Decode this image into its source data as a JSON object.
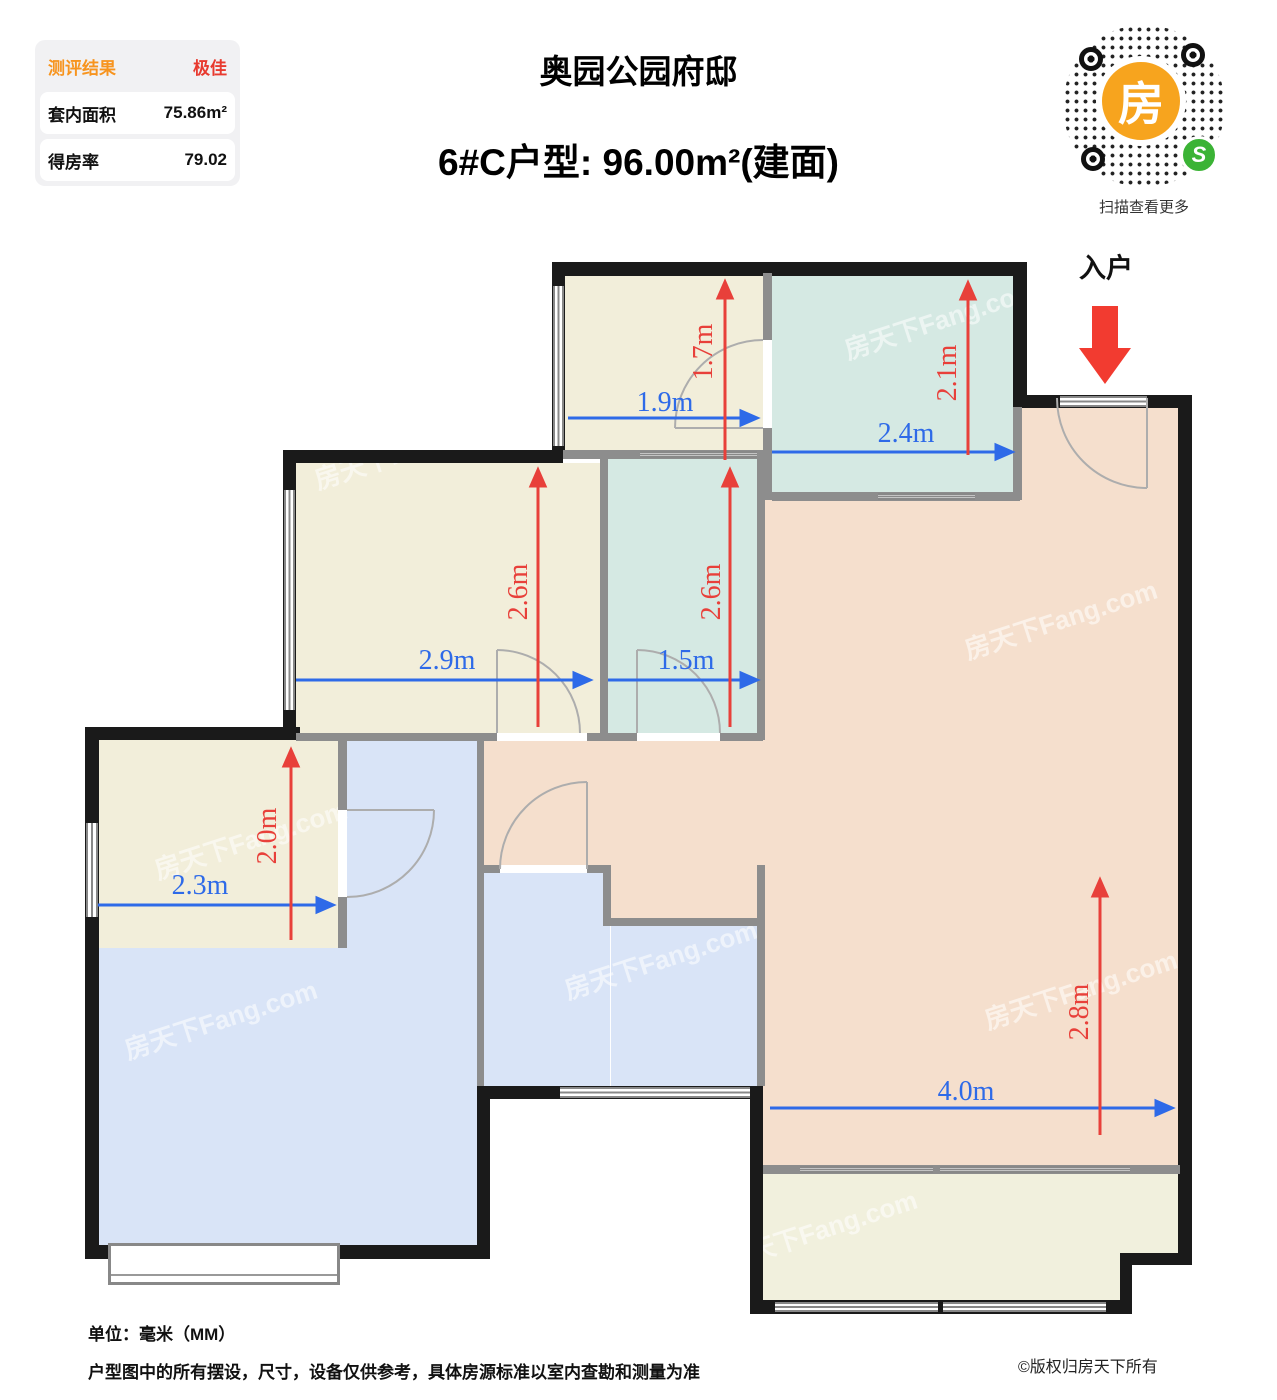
{
  "header": {
    "score_panel": {
      "result_label": "测评结果",
      "result_value": "极佳",
      "area_label": "套内面积",
      "area_value": "75.86m²",
      "rate_label": "得房率",
      "rate_value": "79.02"
    },
    "title": "奥园公园府邸",
    "subtitle": "6#C户型: 96.00m²(建面)",
    "qr": {
      "center_glyph": "房",
      "badge_glyph": "S",
      "caption": "扫描查看更多"
    }
  },
  "plan": {
    "entrance_label": "入户",
    "watermark": "房天下Fang.com",
    "dims": [
      {
        "label": "1.9m",
        "axis": "horizontal"
      },
      {
        "label": "1.7m",
        "axis": "vertical"
      },
      {
        "label": "2.4m",
        "axis": "horizontal"
      },
      {
        "label": "2.1m",
        "axis": "vertical"
      },
      {
        "label": "2.9m",
        "axis": "horizontal"
      },
      {
        "label": "2.6m",
        "axis": "vertical"
      },
      {
        "label": "1.5m",
        "axis": "horizontal"
      },
      {
        "label": "2.6m",
        "axis": "vertical"
      },
      {
        "label": "2.3m",
        "axis": "horizontal"
      },
      {
        "label": "2.0m",
        "axis": "vertical"
      },
      {
        "label": "4.0m",
        "axis": "horizontal"
      },
      {
        "label": "2.8m",
        "axis": "vertical"
      }
    ]
  },
  "footer": {
    "unit": "单位：毫米（MM）",
    "disclaimer": "户型图中的所有摆设，尺寸，设备仅供参考，具体房源标准以室内查勘和测量为准",
    "copyright": "©版权归房天下所有"
  },
  "colors": {
    "beige": "#f2eeda",
    "teal": "#d5e9e3",
    "blue": "#d9e4f7",
    "peach": "#f5dfcd",
    "balcony": "#f1f0dd",
    "wallBlack": "#1a1a1a",
    "wallGray": "#8d8d8d",
    "dimBlue": "#2e6ae8",
    "dimRed": "#e8403a",
    "accentOrange": "#f7941e",
    "accentRed": "#e83a2f",
    "qrOrange": "#f7a41e",
    "qrGreen": "#3bb335"
  }
}
